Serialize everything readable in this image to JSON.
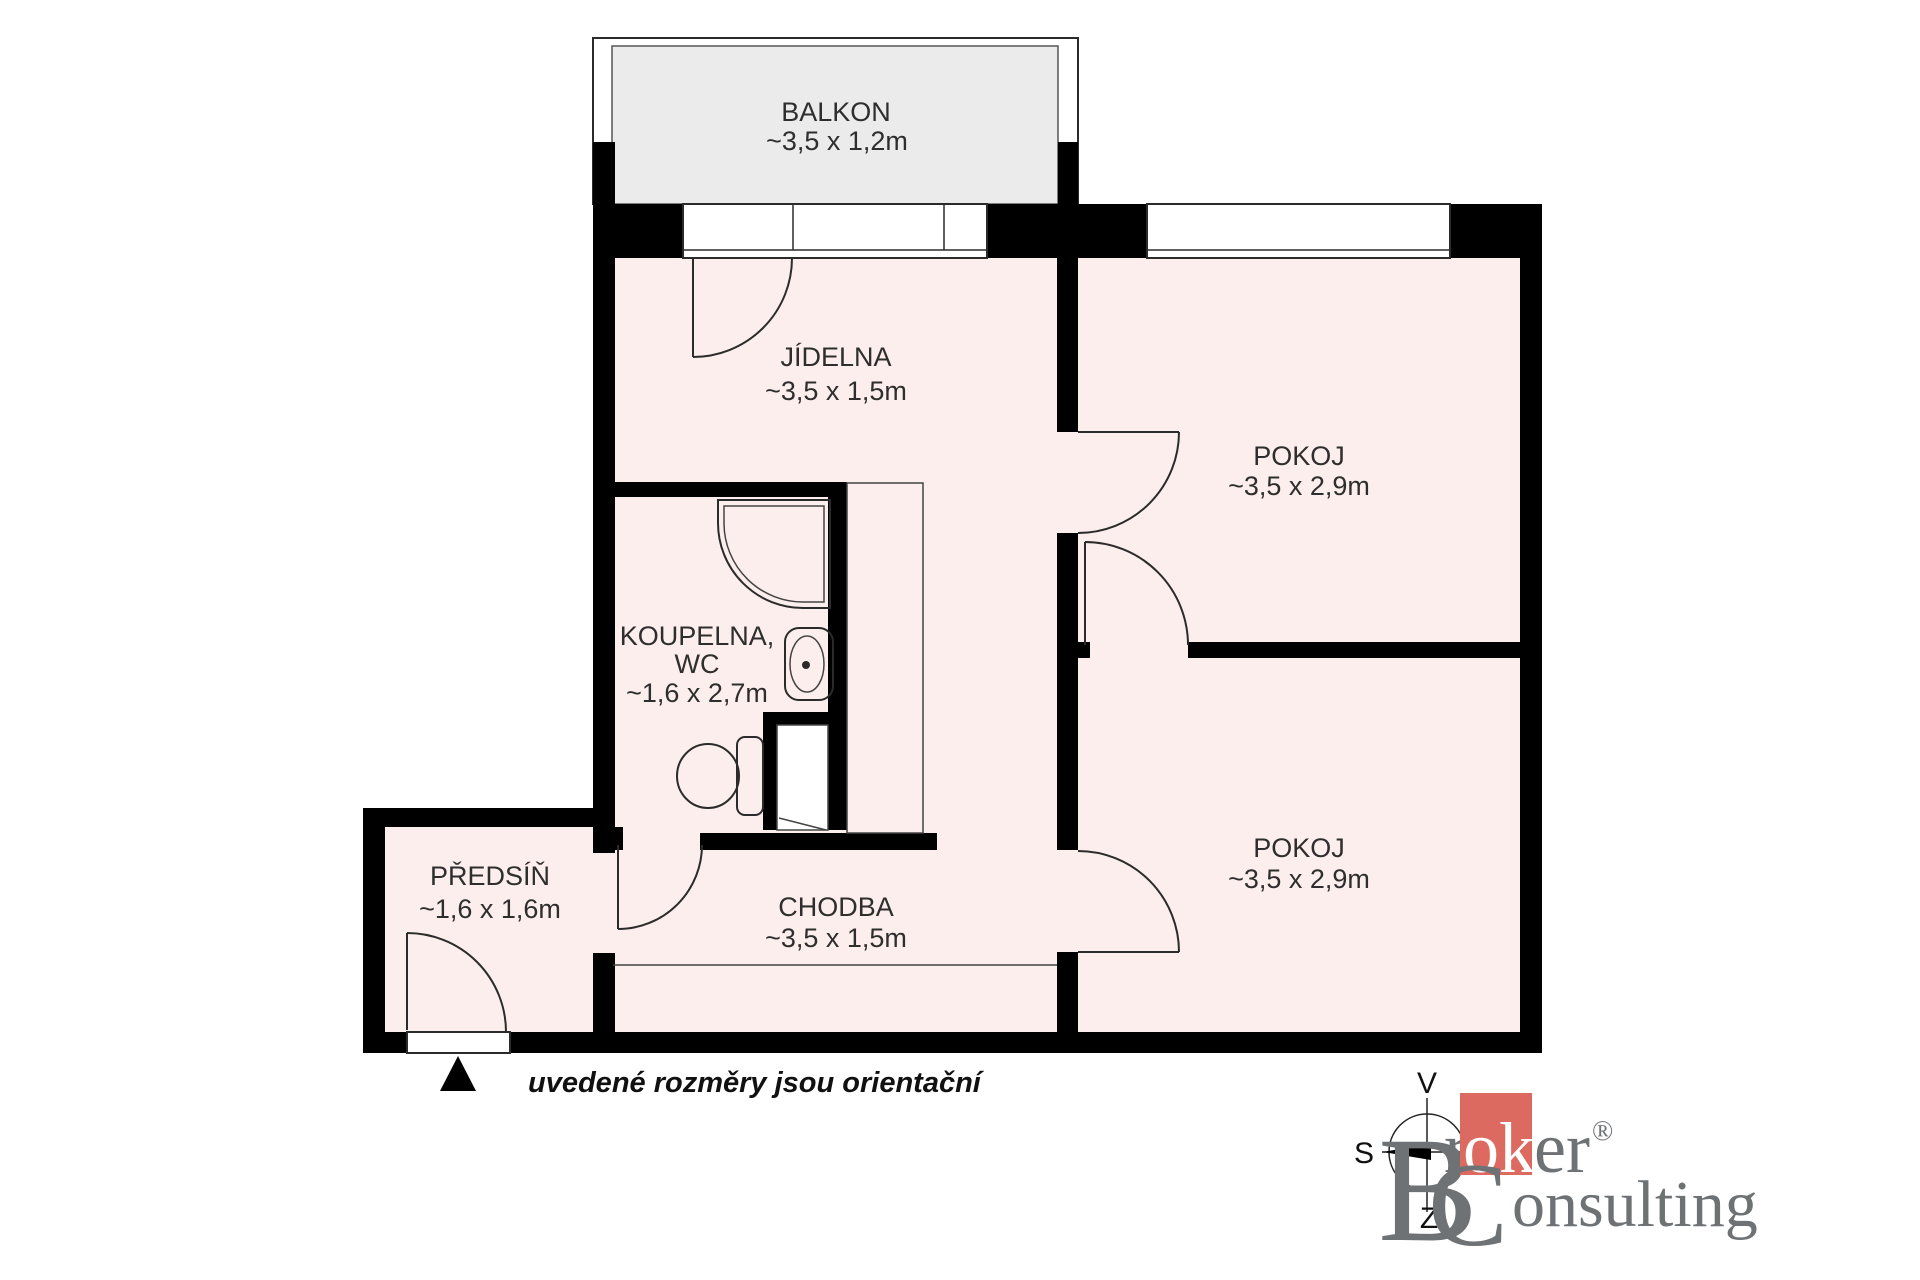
{
  "floorplan": {
    "rooms": [
      {
        "key": "balkon",
        "label": "BALKON",
        "dims": "~3,5 x 1,2m"
      },
      {
        "key": "jidelna",
        "label": "JÍDELNA",
        "dims": "~3,5 x 1,5m"
      },
      {
        "key": "pokoj-top",
        "label": "POKOJ",
        "dims": "~3,5 x 2,9m"
      },
      {
        "key": "koupelna-wc",
        "label": "KOUPELNA,",
        "label_line2": "WC",
        "dims": "~1,6 x 2,7m"
      },
      {
        "key": "predsin",
        "label": "PŘEDSÍŇ",
        "dims": "~1,6 x 1,6m"
      },
      {
        "key": "chodba",
        "label": "CHODBA",
        "dims": "~3,5 x 1,5m"
      },
      {
        "key": "pokoj-bottom",
        "label": "POKOJ",
        "dims": "~3,5 x 2,9m"
      }
    ],
    "disclaimer": "uvedené rozměry jsou orientační",
    "compass": {
      "top": "V",
      "left": "S",
      "bottom": "Z"
    },
    "icons": {
      "entrance_marker": "▲"
    }
  },
  "branding": {
    "logo": {
      "b": "B",
      "r": "r",
      "ok": "ok",
      "er": "er",
      "registered": "®",
      "c": "C",
      "onsulting": "onsulting"
    }
  },
  "colors": {
    "room_fill": "#fceeec",
    "balcony_fill": "#ebebeb",
    "wall": "#000000",
    "line": "#2b2b2b",
    "label_text": "#2e2e2e",
    "logo_red": "#dc6a60",
    "logo_gray": "#6f7275"
  }
}
